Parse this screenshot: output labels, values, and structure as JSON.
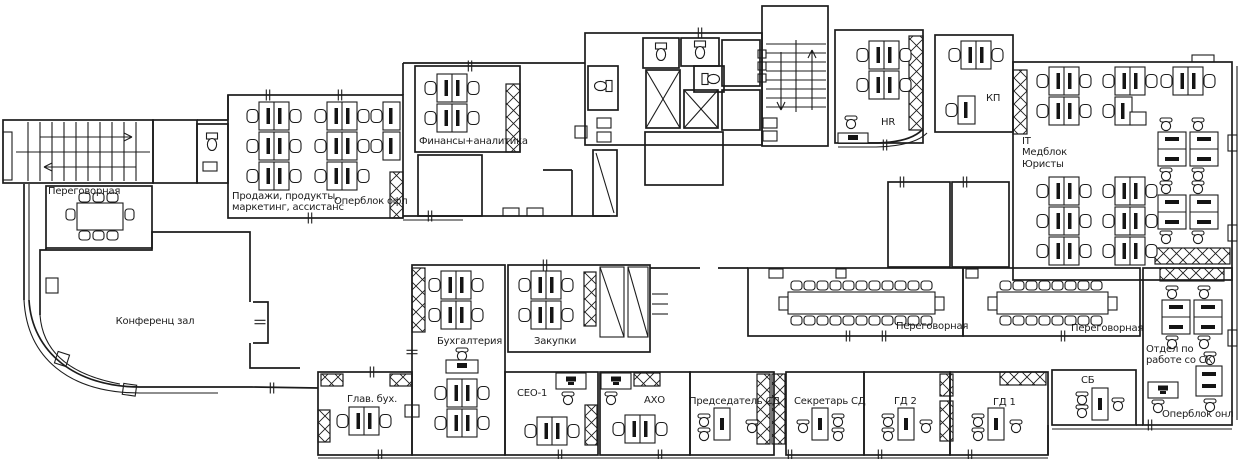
{
  "floor_plan": {
    "title": "Office floor plan",
    "colors": {
      "line": "#1c1c1c",
      "background": "#ffffff"
    },
    "rooms": [
      {
        "id": "meeting-room-top-left",
        "label": "Переговорная"
      },
      {
        "id": "conference-hall",
        "label": "Конференц зал"
      },
      {
        "id": "sales-products",
        "label": "Продажи, продукты,\nмаркетинг, ассистанс"
      },
      {
        "id": "operblock-offline",
        "label": "Оперблок офл"
      },
      {
        "id": "finance-analytics",
        "label": "Финансы+аналитика"
      },
      {
        "id": "hr",
        "label": "HR"
      },
      {
        "id": "kp",
        "label": "КП"
      },
      {
        "id": "it-medblock-lawyers",
        "label": "IT\nМедблок\nЮристы"
      },
      {
        "id": "accounting",
        "label": "Бухгалтерия"
      },
      {
        "id": "procurement",
        "label": "Закупки"
      },
      {
        "id": "chief-accountant",
        "label": "Глав. бух."
      },
      {
        "id": "ceo-1",
        "label": "СЕО-1"
      },
      {
        "id": "aho",
        "label": "АХО"
      },
      {
        "id": "board-chairman",
        "label": "Председатель СД"
      },
      {
        "id": "board-secretary",
        "label": "Секретарь СД"
      },
      {
        "id": "gd-2",
        "label": "ГД 2"
      },
      {
        "id": "gd-1",
        "label": "ГД 1"
      },
      {
        "id": "sb",
        "label": "СБ"
      },
      {
        "id": "meeting-room-central",
        "label": "Переговорная"
      },
      {
        "id": "meeting-room-east",
        "label": "Переговорная"
      },
      {
        "id": "insurance-dept",
        "label": "Отдел по\nработе со СК"
      },
      {
        "id": "operblock-online",
        "label": "Оперблок онл"
      }
    ]
  }
}
